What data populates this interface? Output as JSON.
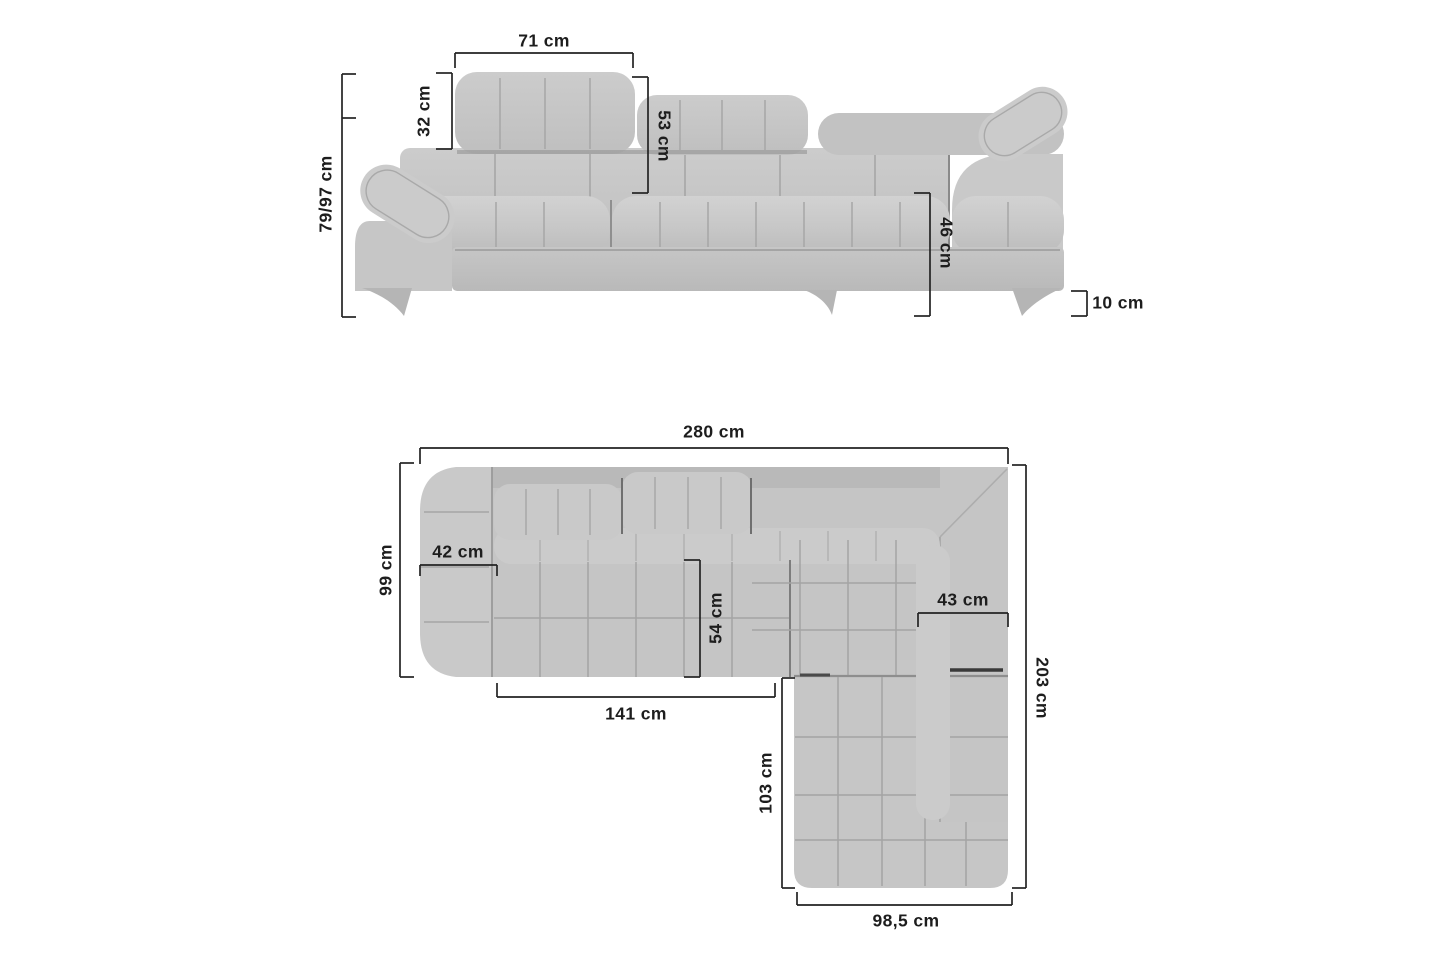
{
  "diagram": {
    "type": "corner-sofa-dimension-drawing",
    "background_color": "#ffffff",
    "sofa_fill_color": "#c7c7c7",
    "seam_color": "#a6a6a6",
    "dimension_line_color": "#232323",
    "text_color": "#1d1d1d",
    "views": {
      "front": {
        "name": "front-elevation",
        "dims": {
          "headrest_width": "71 cm",
          "headrest_height": "32 cm",
          "backrest_height": "53 cm",
          "overall_height": "79/97 cm",
          "seat_front_height": "46 cm",
          "leg_height": "10 cm"
        }
      },
      "plan": {
        "name": "top-plan",
        "dims": {
          "overall_width": "280 cm",
          "side_depth": "99 cm",
          "armrest_width": "42 cm",
          "seat_depth": "54 cm",
          "seat_width": "141 cm",
          "corner_seat_width": "43 cm",
          "overall_depth": "203 cm",
          "chaise_length": "103 cm",
          "chaise_width": "98,5 cm"
        }
      }
    }
  }
}
